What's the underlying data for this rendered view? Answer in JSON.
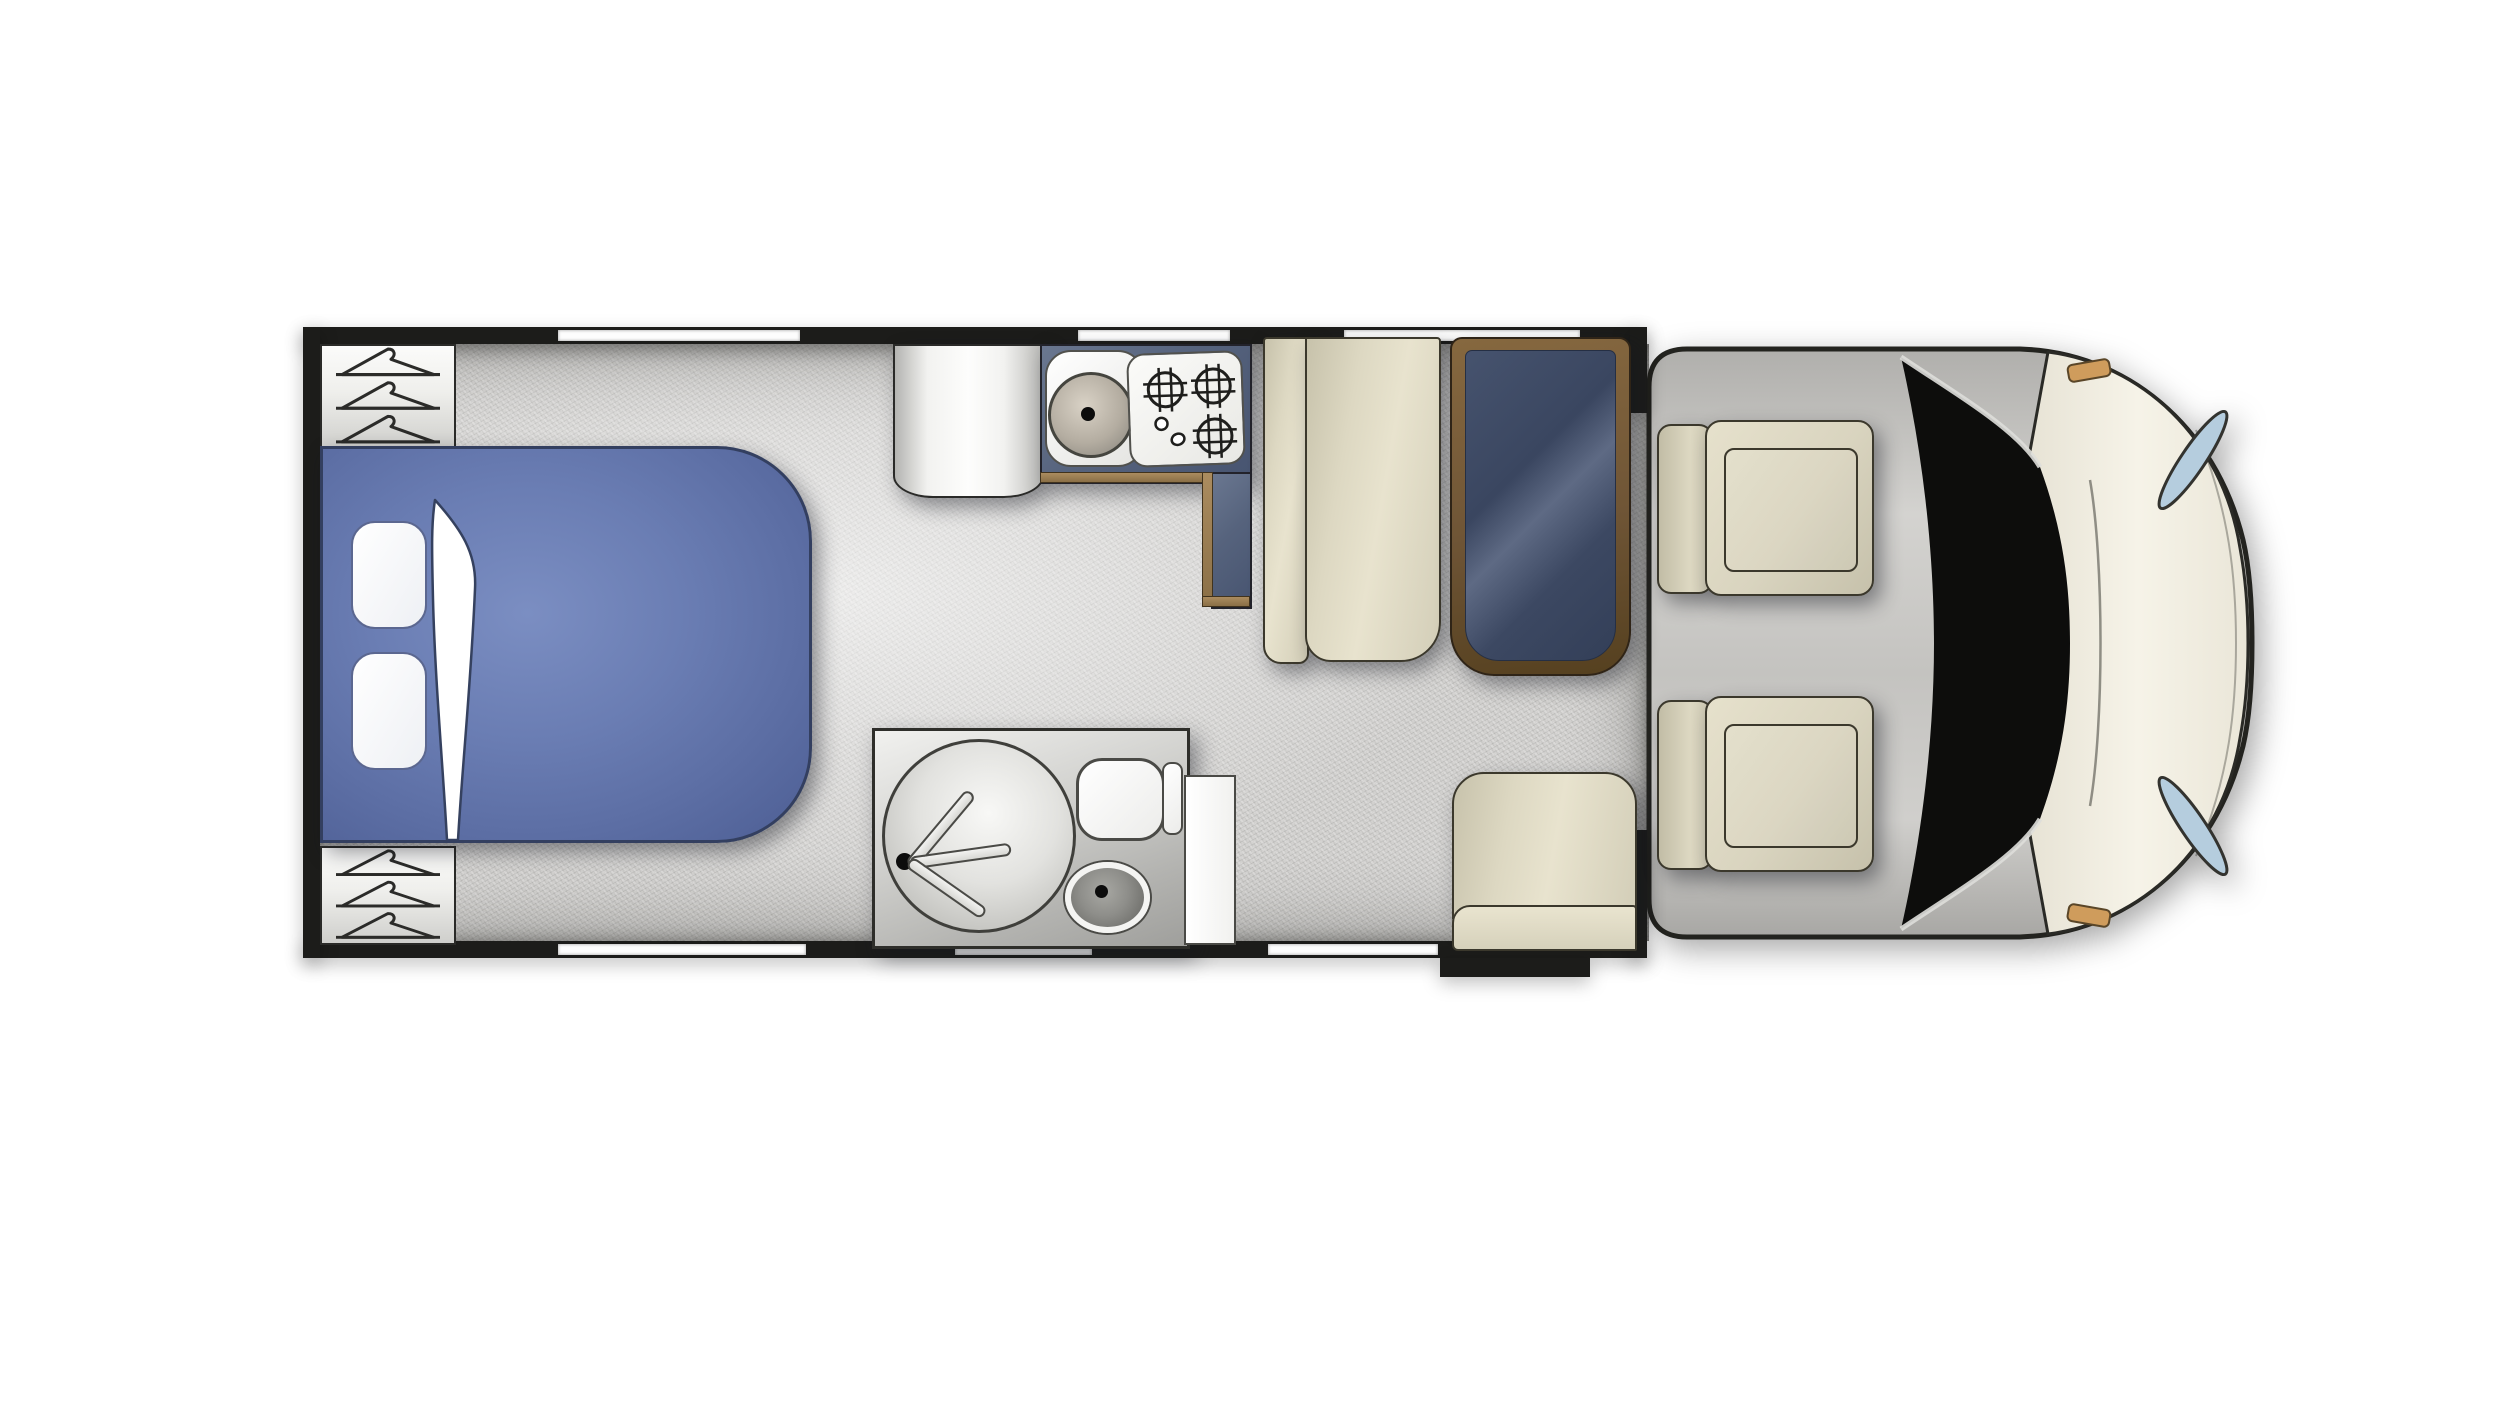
{
  "page": {
    "title": "Motorhome floor plan - top view",
    "background": "#ffffff"
  },
  "palette": {
    "wall": "#1c1c1a",
    "floor": "#d2d1cf",
    "window": "#fdfdfd",
    "bed_blue": "#6a7db3",
    "upholstery_cream": "#ddd8c2",
    "counter_slate": "#56637d",
    "wood_trim": "#8a6f46",
    "table_navy": "#3a4660",
    "table_rim_brown": "#6f5536",
    "fixture_white": "#f6f6f4",
    "cab_hood_cream": "#f0ecdf",
    "windshield_black": "#0d0d0c",
    "headlight_blue": "#b5cdde",
    "marker_orange": "#cf9c5c"
  },
  "rooms": {
    "bedroom": {
      "label": "Bedroom with double bed",
      "pillow_count": 2,
      "wardrobe_top": {
        "label": "Wardrobe with hangers",
        "hanger_count": 3
      },
      "wardrobe_bottom": {
        "label": "Wardrobe with hangers",
        "hanger_count": 3
      }
    },
    "kitchen": {
      "label": "Kitchen unit",
      "fridge_label": "Fridge / tall cabinet",
      "sink_label": "Round sink with drain",
      "hob_label": "Gas hob",
      "burner_count": 3,
      "knob_count": 2
    },
    "bathroom": {
      "label": "Bathroom",
      "shower_label": "Round shower tray",
      "shower_jet_count": 3,
      "toilet_label": "Toilet with cistern",
      "basin_label": "Washbasin",
      "door_label": "Bathroom door panel"
    },
    "dinette": {
      "label": "Dinette",
      "bench_label": "Bench seat",
      "table_label": "Dining table",
      "entry_bench_label": "Entry bench seat"
    },
    "entry": {
      "label": "Entrance step"
    },
    "cab": {
      "label": "Driver cab",
      "seat_count": 2,
      "seat_label": "Swivel captain seat",
      "windshield_label": "Windshield",
      "headlight_count": 2,
      "marker_count": 2
    }
  },
  "windows": {
    "top_wall_count": 3,
    "bottom_wall_count": 3
  }
}
